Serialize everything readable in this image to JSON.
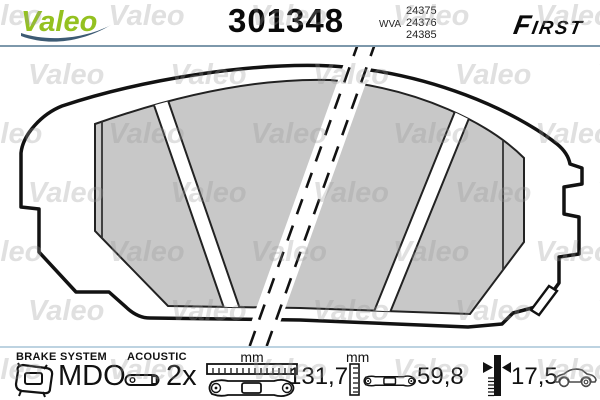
{
  "header": {
    "brand": "Valeo",
    "part_number": "301348",
    "wva_label": "WVA",
    "wva_numbers": [
      "24375",
      "24376",
      "24385"
    ],
    "range_label": "FIRST"
  },
  "watermark": {
    "text": "Valeo",
    "row": "Valeo Valeo Valeo Valeo Valeo"
  },
  "footer": {
    "brake_system_label": "BRAKE SYSTEM",
    "brake_system_value": "MDO",
    "acoustic_label": "ACOUSTIC",
    "acoustic_value": "2x",
    "width_unit": "mm",
    "width_value": "131,7",
    "height_unit": "mm",
    "height_value": "59,8",
    "thickness_value": "17,5"
  },
  "colors": {
    "brand_green": "#94c120",
    "swoosh_blue": "#3d5b74",
    "header_divider": "#7d98ab",
    "footer_divider": "#bdd3e1",
    "friction_gray": "#c8c8c8",
    "line_black": "#121212"
  }
}
